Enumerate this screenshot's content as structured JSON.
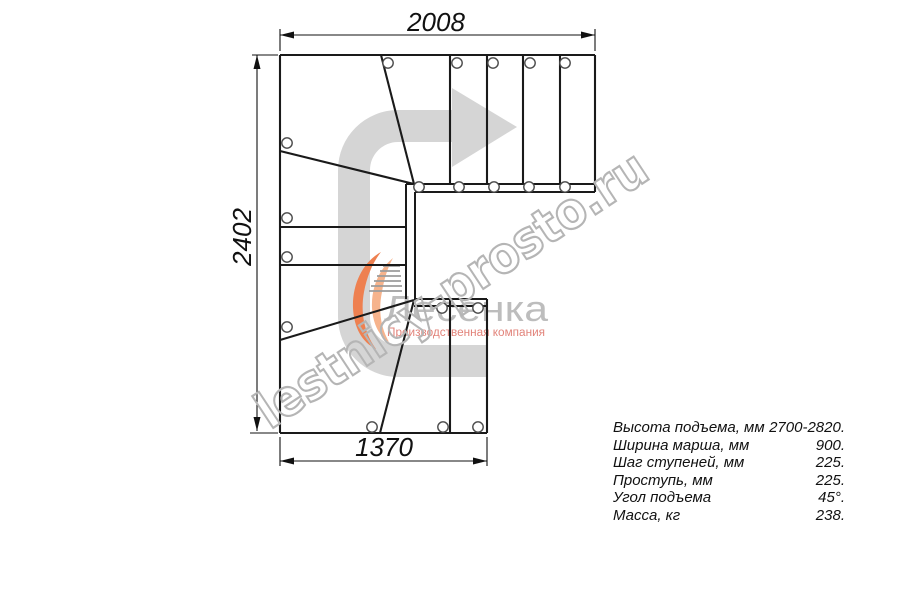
{
  "dimensions": {
    "top_width_mm": "2008",
    "left_height_mm": "2402",
    "bottom_width_mm": "1370"
  },
  "logo": {
    "name": "Лесенка",
    "tagline": "Производственная компания",
    "colors": {
      "swoosh_orange": "#ee8050",
      "swoosh_light": "#f6b38c",
      "name_gray": "#bdbdbd",
      "tagline_salmon": "#e2837a"
    }
  },
  "watermark": {
    "text": "lestnicy-prosto.ru",
    "color": "#b5b5b5"
  },
  "direction_arrow": {
    "color": "#d5d5d5"
  },
  "specs": {
    "rows": [
      {
        "label": "Высота подъема, мм",
        "value": "2700-2820."
      },
      {
        "label": "Ширина марша, мм",
        "value": "900."
      },
      {
        "label": "Шаг ступеней, мм",
        "value": "225."
      },
      {
        "label": "Проступь, мм",
        "value": "225."
      },
      {
        "label": "Угол подъема",
        "value": "45°."
      },
      {
        "label": "Масса, кг",
        "value": "238."
      }
    ]
  }
}
